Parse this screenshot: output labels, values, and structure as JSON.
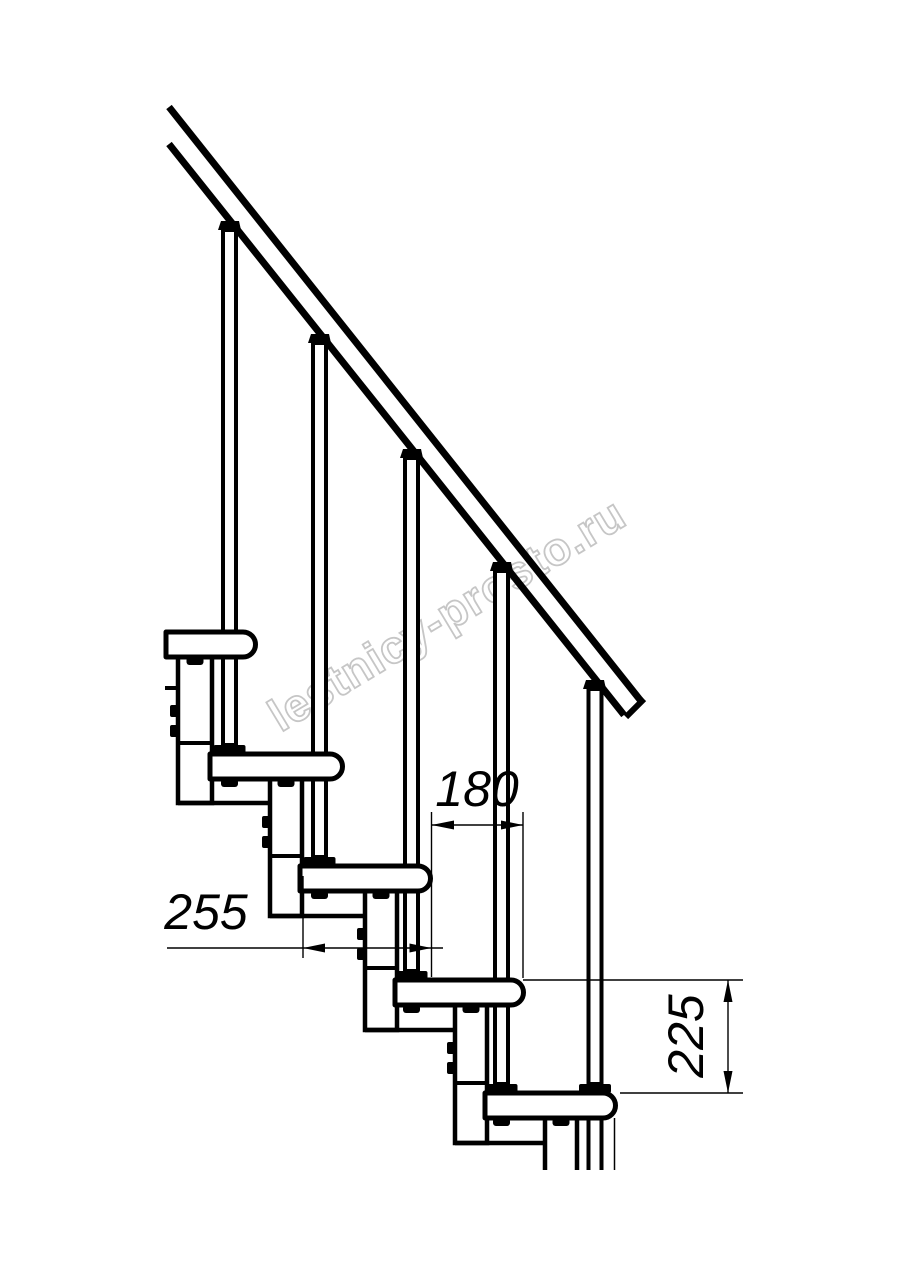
{
  "page": {
    "background": "#ffffff",
    "line_color": "#000000"
  },
  "drawing": {
    "type": "modular-staircase-side-view",
    "watermark": {
      "text": "lestnicy-prosto.ru",
      "color": "#c6c6c6"
    },
    "dimensions": [
      {
        "id": "step_run",
        "label": "180",
        "orientation": "horizontal"
      },
      {
        "id": "tread_depth",
        "label": "255",
        "orientation": "horizontal"
      },
      {
        "id": "step_rise",
        "label": "225",
        "orientation": "vertical"
      }
    ]
  }
}
